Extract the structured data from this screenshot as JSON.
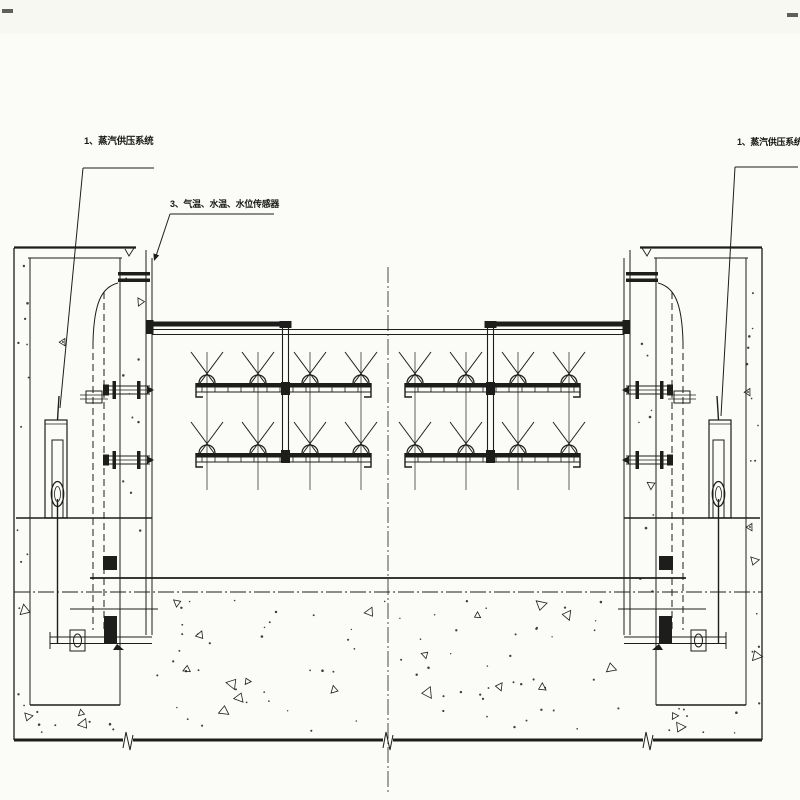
{
  "drawing": {
    "colors": {
      "background": "#fbfbf7",
      "ink": "#1d1d1b"
    },
    "labels": {
      "left_system": "1、蒸汽供压系统",
      "sensors": "3、气温、水温、水位传感器",
      "right_system": "1、蒸汽供压系统"
    }
  }
}
